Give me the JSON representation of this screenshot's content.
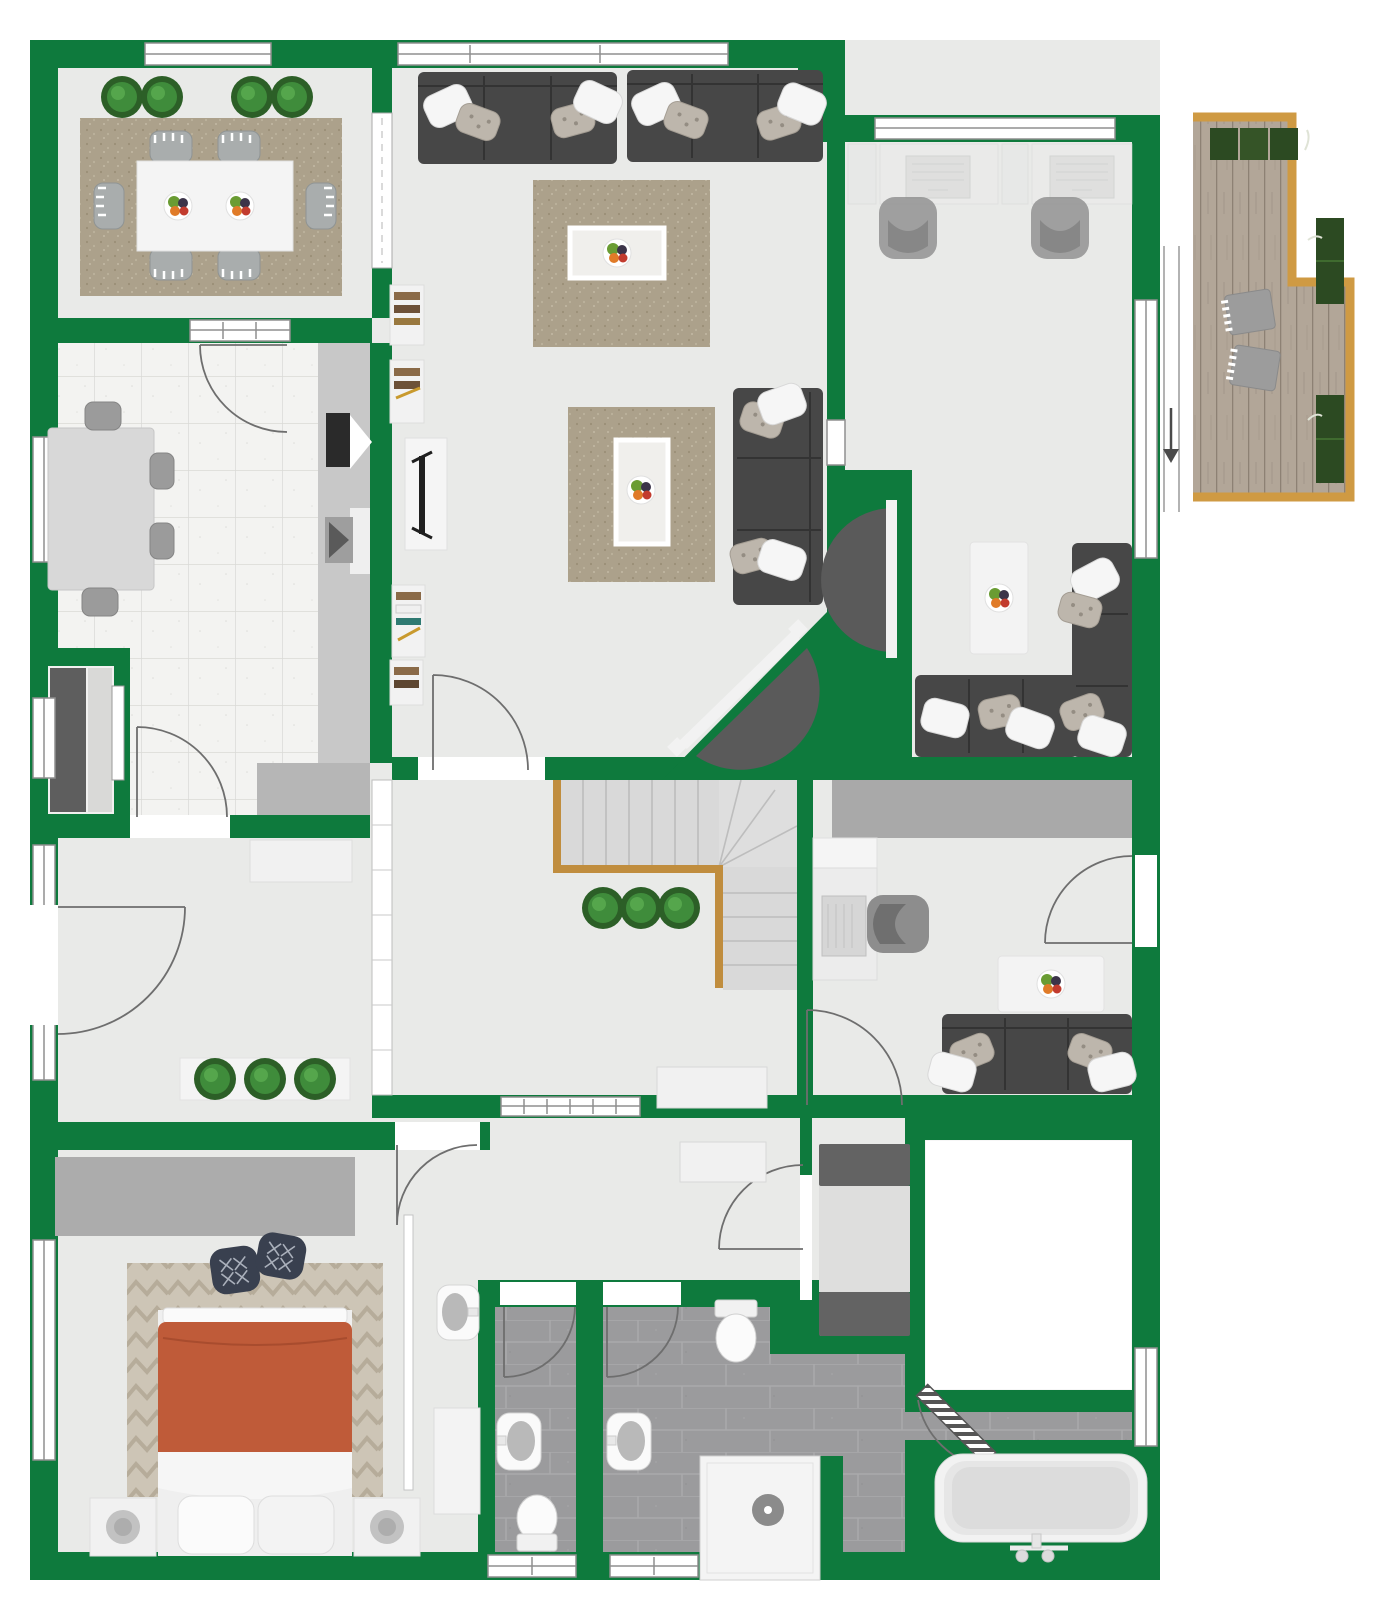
{
  "app": {
    "type": "floor-plan-viewer",
    "view": "2d-top-down",
    "visible_text": ""
  },
  "colors": {
    "wall": "#0e7a3d",
    "wallDark": "#0a6a34",
    "floor": "#e9eae8",
    "kitchenTile": "#f3f3f1",
    "kitchenGrout": "#d9d9d6",
    "bathTile": "#9b9b9d",
    "bathGrout": "#adadaf",
    "deckWood": "#b2a698",
    "deckLine": "#8d8174",
    "deckBorder": "#cf9a43",
    "rug": "#aca18b",
    "rugLight": "#f0efec",
    "bedroomRug": "#cdc5b6",
    "sofa": "#474747",
    "sofaLine": "#333333",
    "bed": "#bf5b39",
    "plant": "#3f8c3b",
    "plantDark": "#2c5f27",
    "stairRail": "#c08d3e",
    "stairTread": "#d9d9d9",
    "counter": "#c8c8c8",
    "closet": "#ababab",
    "appliance": "#636363",
    "whiteFurniture": "#f3f3f3",
    "frame": "#8f8f8f",
    "doorArc": "#6e6e6e"
  },
  "rooms": {
    "dining": {
      "label": "dining-room",
      "furniture": [
        "dining-table",
        "6 chairs",
        "2 fruit-bowls",
        "rug",
        "4 plants"
      ]
    },
    "kitchen": {
      "label": "kitchen",
      "furniture": [
        "breakfast-table",
        "4 chairs",
        "counter",
        "cooktop",
        "sink",
        "fridge-niche"
      ]
    },
    "living": {
      "label": "living-room",
      "furniture": [
        "2 sofas",
        "corner-sofa",
        "2 rugs",
        "2 coffee-tables",
        "bookshelves",
        "tv-cabinet",
        "corner-tv"
      ]
    },
    "officeTR": {
      "label": "office-top-right",
      "furniture": [
        "2 desks",
        "2 laptops",
        "2 office-chairs",
        "sectional-sofa",
        "coffee-table",
        "wall-tv"
      ]
    },
    "deck": {
      "label": "roof-deck",
      "furniture": [
        "2 loungers",
        "5 planters",
        "entry-arrow"
      ]
    },
    "stairHall": {
      "label": "stair-hall",
      "furniture": [
        "l-shaped-stairs",
        "3 plants",
        "bench"
      ]
    },
    "foyer": {
      "label": "entrance-hall",
      "furniture": [
        "entrance-door",
        "sideboard",
        "planter-box",
        "shelf-partition"
      ]
    },
    "study": {
      "label": "study",
      "furniture": [
        "desk",
        "laptop",
        "office-chair",
        "sofa",
        "coffee-table",
        "wardrobe"
      ]
    },
    "bedroom": {
      "label": "bedroom",
      "furniture": [
        "double-bed",
        "2 nightstands",
        "2 poufs",
        "chevron-rug",
        "closet",
        "wash-basin",
        "dresser"
      ]
    },
    "hallway": {
      "label": "lower-hallway",
      "furniture": [
        "sideboard"
      ]
    },
    "utility": {
      "label": "utility-room",
      "furniture": [
        "washer",
        "dryer"
      ]
    },
    "whiteRoom": {
      "label": "unfinished-room",
      "furniture": []
    },
    "wc": {
      "label": "wc",
      "furniture": [
        "sink",
        "toilet"
      ]
    },
    "bathroom": {
      "label": "bathroom",
      "furniture": [
        "sink",
        "toilet",
        "shower",
        "bathtub"
      ]
    }
  },
  "icons": {
    "arrow": "entry-direction-arrow"
  }
}
